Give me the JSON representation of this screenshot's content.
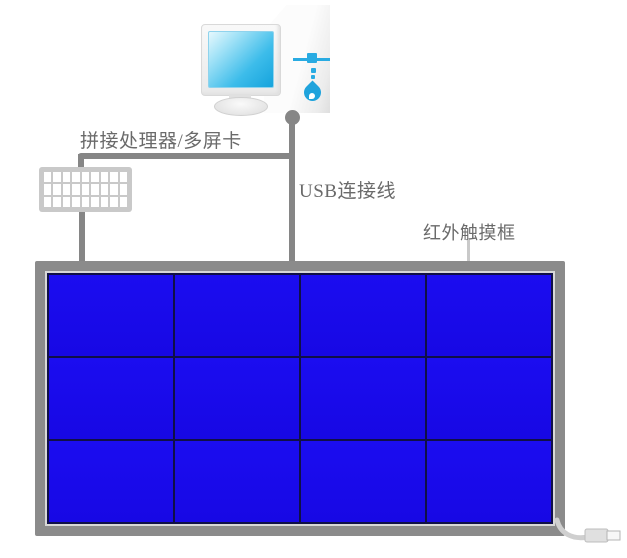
{
  "labels": {
    "processor": "拼接处理器/多屏卡",
    "usb_cable": "USB连接线",
    "touch_frame": "红外触摸框"
  },
  "video_wall": {
    "columns": 4,
    "rows": 3,
    "panel_count": 12,
    "panel_color": "#1b0df0",
    "divider_color": "#101047",
    "frame_color": "#8b8b8b"
  },
  "splitter_device": {
    "grid_columns": 9,
    "grid_rows": 3,
    "body_color": "#c9c9c9"
  },
  "colors": {
    "cable_gray": "#868686",
    "label_text": "#6a6a6a",
    "accent_cyan": "#29abe2",
    "screen_cyan": "#2fb5e8",
    "pointer_light_gray": "#c9c9c9"
  }
}
